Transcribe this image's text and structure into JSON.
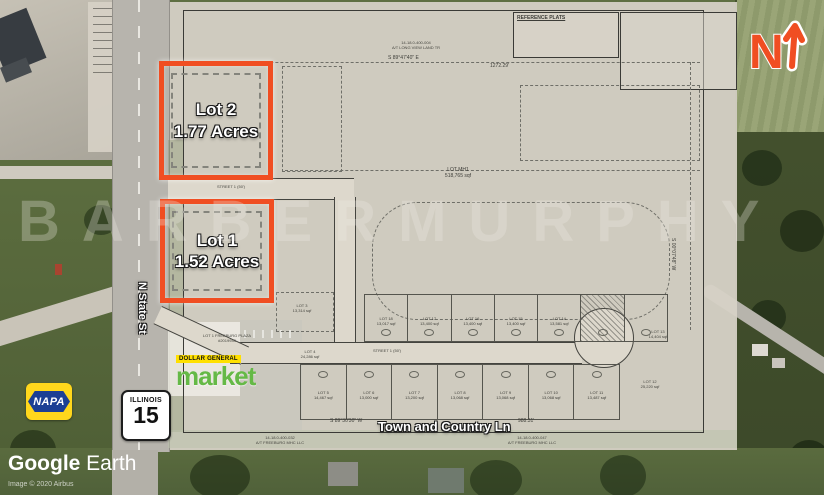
{
  "colors": {
    "accent_orange": "#F04E22",
    "napa_blue": "#1C3F94",
    "napa_yellow": "#FFD71C",
    "dg_yellow": "#FFE000",
    "dg_green": "#65B946",
    "plan_paper": "#D7D1C5"
  },
  "watermark": {
    "text": "BARBERMURPHY"
  },
  "credits": {
    "app_bold": "Google",
    "app_light": " Earth",
    "imagery": "Image © 2020 Airbus"
  },
  "compass": {
    "label": "N"
  },
  "roads": {
    "n_state_st": "N State St",
    "town_and_country_ln": "Town and Country Ln",
    "shield_state": "ILLINOIS",
    "shield_number": "15"
  },
  "featured_lots": {
    "lot2_name": "Lot 2",
    "lot2_size": "1.77 Acres",
    "lot1_name": "Lot 1",
    "lot1_size": "1.52 Acres"
  },
  "logos": {
    "napa": "NAPA",
    "dollar_general": "DOLLAR GENERAL",
    "market": "market"
  },
  "plan": {
    "reference_plats": "REFERENCE PLATS",
    "street1_upper": "STREET 1 (50')",
    "street1_lower": "STREET 1 (50')",
    "lot_mh1_name": "LOT MH1",
    "lot_mh1_area": "518,765 sqf",
    "plaza_line1": "LOT 1 FREEBURG PLAZA",
    "plaza_line2": "#2019943",
    "dim_top_bearing": "S 89°47'40\" E",
    "dim_top_length": "1272.29'",
    "dim_bottom_bearing": "S 89°30'30\" W",
    "dim_bottom_length": "988.31'",
    "dim_right_bearing": "S 00°07'48\" W",
    "parcel_top_id": "14-18.0-400-004",
    "parcel_top_owner": "A/T LONG VIEW LAND TR",
    "parcel_bl_id": "14-18.0-400-032",
    "parcel_bl_owner": "A/T FREEBURG MHC LLC",
    "parcel_br_id": "14-18.0-400-047",
    "parcel_br_owner": "A/T FREEBURG MHC LLC",
    "lots_top": [
      {
        "name": "LOT 18",
        "area": "13,017 sqf"
      },
      {
        "name": "LOT 17",
        "area": "13,400 sqf"
      },
      {
        "name": "LOT 16",
        "area": "13,400 sqf"
      },
      {
        "name": "LOT 15",
        "area": "13,400 sqf"
      },
      {
        "name": "LOT 14",
        "area": "13,581 sqf"
      }
    ],
    "lots_bottom": [
      {
        "name": "LOT 5",
        "area": "14,467 sqf"
      },
      {
        "name": "LOT 6",
        "area": "13,000 sqf"
      },
      {
        "name": "LOT 7",
        "area": "13,200 sqf"
      },
      {
        "name": "LOT 8",
        "area": "13,068 sqf"
      },
      {
        "name": "LOT 9",
        "area": "13,068 sqf"
      },
      {
        "name": "LOT 10",
        "area": "13,068 sqf"
      },
      {
        "name": "LOT 11",
        "area": "13,487 sqf"
      }
    ],
    "lots_west": [
      {
        "name": "LOT 3",
        "area": "13,314 sqf"
      },
      {
        "name": "LOT 4",
        "area": "24,286 sqf"
      }
    ],
    "lots_east": [
      {
        "name": "LOT 13",
        "area": "14,404 sqf"
      },
      {
        "name": "LOT 12",
        "area": "25,220 sqf"
      }
    ]
  }
}
